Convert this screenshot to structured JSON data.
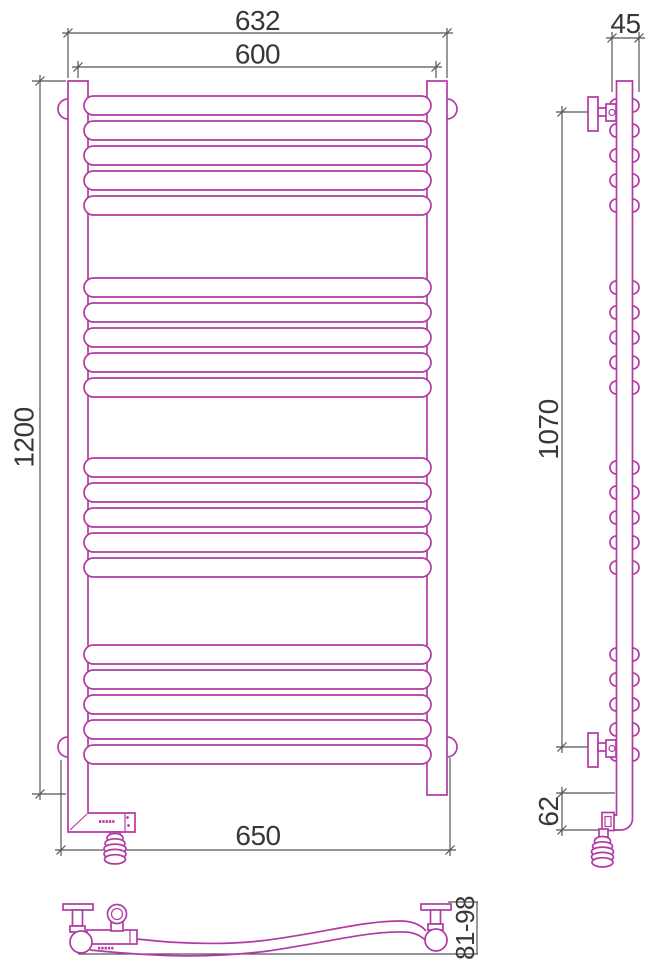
{
  "drawing": {
    "title": "heated-towel-rail-technical-drawing",
    "labels": {
      "width_overall": "632",
      "width_centers": "600",
      "height_overall": "1200",
      "width_bottom": "650",
      "side_depth": "45",
      "side_mount_height": "1070",
      "side_bottom_offset": "62",
      "depth_range": "81-98"
    },
    "colors": {
      "product": "#b23aa2",
      "dimension": "#55555a",
      "label_text": "#38383c",
      "background": "#ffffff"
    },
    "front_view": {
      "rung_x": 84,
      "rung_width": 347,
      "rung_height": 19,
      "rung_group_tops": [
        [
          96,
          121,
          146,
          171,
          196
        ],
        [
          278,
          303,
          328,
          353,
          378
        ],
        [
          458,
          483,
          508,
          533,
          558
        ],
        [
          645,
          670,
          695,
          720,
          745
        ]
      ]
    },
    "side_view": {
      "bump_centers_x": [
        616.5,
        632.5
      ],
      "bump_radius": 6.5
    },
    "heater_leds": {
      "count": 5,
      "dash_width": 2.3,
      "dash_height": 2.7,
      "step": 3.3,
      "positions": [
        {
          "x": 99,
          "y": 820.2,
          "container": "heater-dashes"
        },
        {
          "x": 98,
          "y": 946.8,
          "container": "bottom-dashes"
        }
      ]
    },
    "cable_coils": [
      {
        "container": "front-coil",
        "cx": 115,
        "top": 833.5
      },
      {
        "container": "side-coil",
        "cx": 602.5,
        "top": 836.5
      }
    ],
    "coil_spec": {
      "loop_rx": [
        8,
        10,
        11,
        11,
        10.5
      ],
      "ry": 4.6,
      "step": 5.3
    }
  }
}
